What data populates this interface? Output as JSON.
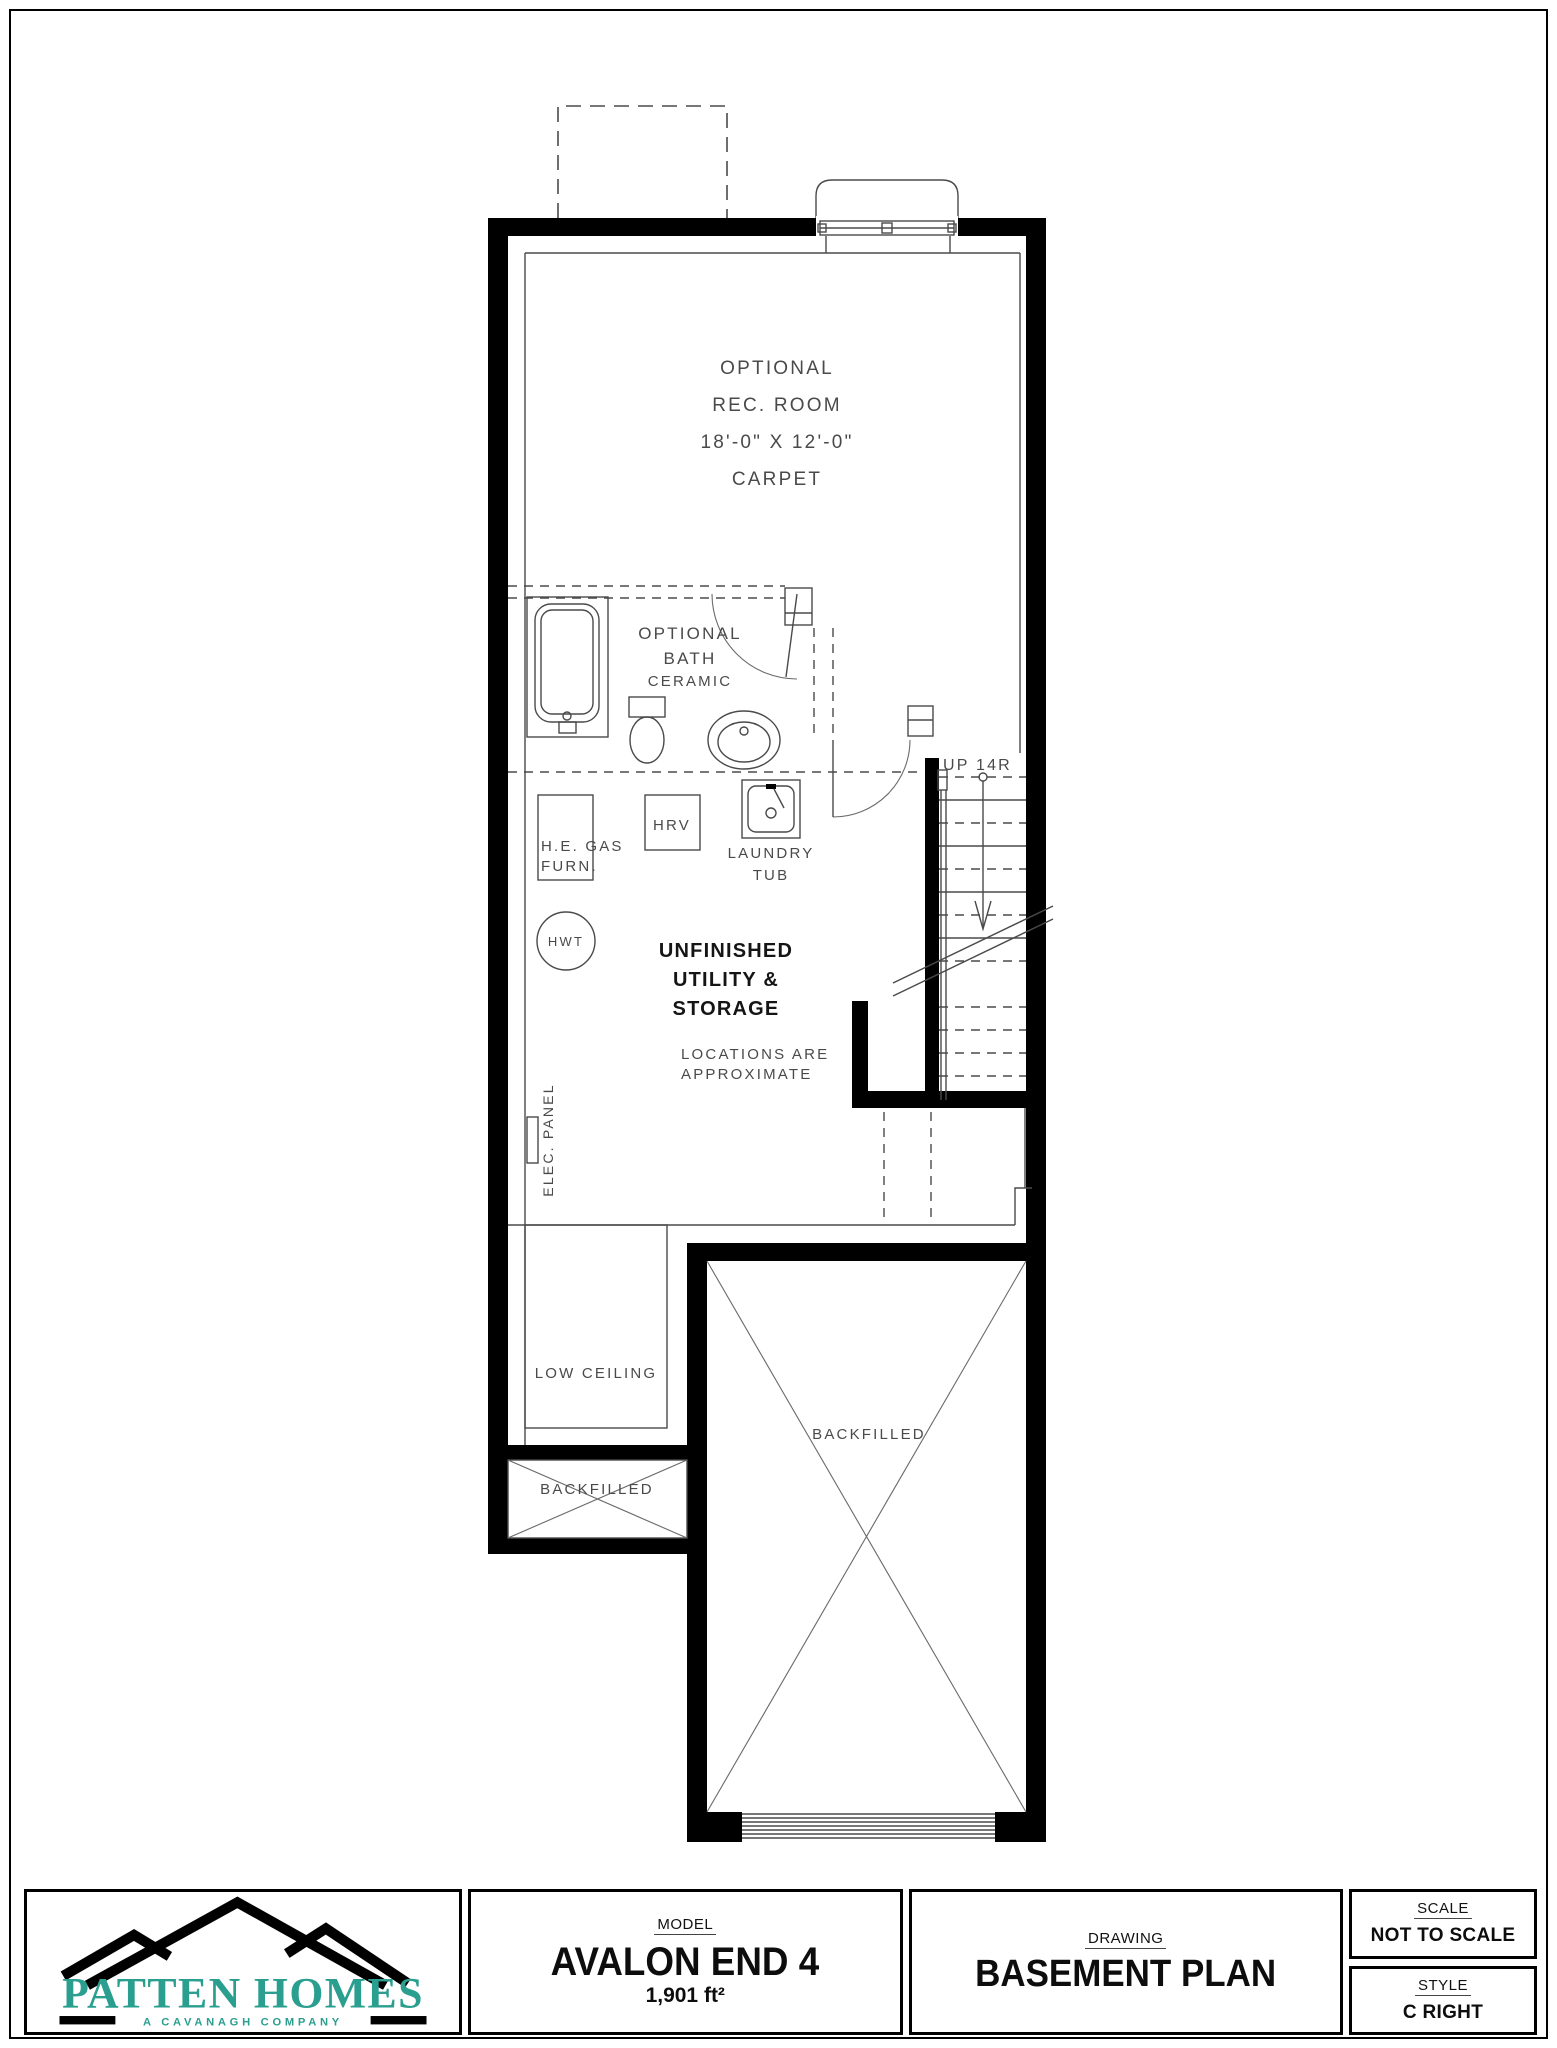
{
  "plan": {
    "rec_room": {
      "l1": "OPTIONAL",
      "l2": "REC. ROOM",
      "l3": "18'-0\" X 12'-0\"",
      "l4": "CARPET"
    },
    "bath": {
      "l1": "OPTIONAL",
      "l2": "BATH",
      "l3": "CERAMIC"
    },
    "stairs": {
      "label": "UP 14R"
    },
    "furnace": {
      "l1": "H.E. GAS",
      "l2": "FURN."
    },
    "hrv": {
      "label": "HRV"
    },
    "laundry": {
      "l1": "LAUNDRY",
      "l2": "TUB"
    },
    "hwt": {
      "label": "HWT"
    },
    "utility": {
      "l1": "UNFINISHED",
      "l2": "UTILITY &",
      "l3": "STORAGE"
    },
    "locations": {
      "l1": "LOCATIONS ARE",
      "l2": "APPROXIMATE"
    },
    "elec_panel": {
      "label": "ELEC. PANEL"
    },
    "low_ceiling": {
      "label": "LOW CEILING"
    },
    "backfilled_small": {
      "label": "BACKFILLED"
    },
    "backfilled_garage": {
      "label": "BACKFILLED"
    }
  },
  "titleblock": {
    "logo": {
      "name": "PATTEN HOMES",
      "tagline": "A CAVANAGH COMPANY",
      "accent_color": "#2a9e8f"
    },
    "model": {
      "label": "MODEL",
      "value": "AVALON END 4",
      "area": "1,901 ft²"
    },
    "drawing": {
      "label": "DRAWING",
      "value": "BASEMENT PLAN"
    },
    "scale": {
      "label": "SCALE",
      "value": "NOT TO SCALE"
    },
    "style": {
      "label": "STYLE",
      "value": "C RIGHT"
    }
  }
}
